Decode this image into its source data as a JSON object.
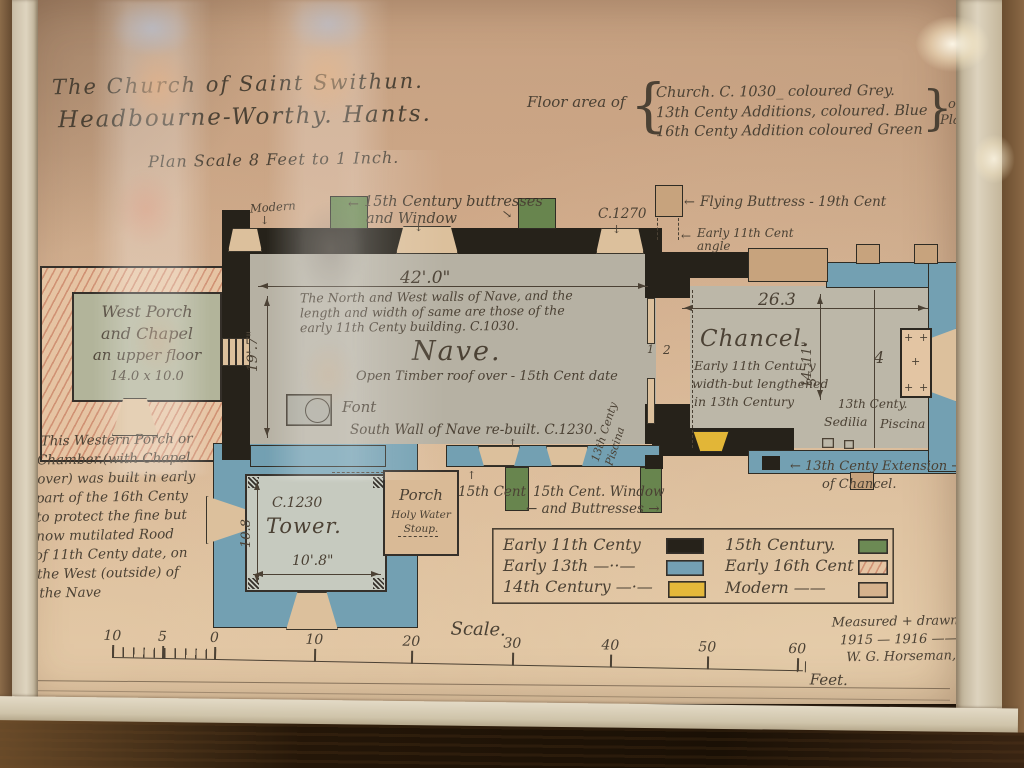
{
  "glyphs": {
    "left_arrow": "←",
    "right_arrow": "→",
    "up_arrow": "↑",
    "down_arrow": "↓",
    "brace_open": "{",
    "brace_close": "}",
    "paren_open": "(",
    "plus": "+"
  },
  "title": {
    "line1": "The Church of Saint Swithun.",
    "line2": "Headbourne-Worthy. Hants.",
    "scale_note": "Plan Scale 8 Feet to 1 Inch."
  },
  "floor_area": {
    "prefix": "Floor area of",
    "line1": "Church. C. 1030_ coloured Grey.",
    "line2": "13th Centy Additions, coloured. Blue",
    "line3": "16th Centy Addition coloured Green",
    "suffix1": "on",
    "suffix2": "Plan."
  },
  "nave": {
    "title": "Nave.",
    "subtitle": "Open Timber roof over - 15th Cent date",
    "width_dim": "42'.0\"",
    "height_dim": "19'.7\"",
    "note1": "The North and West walls of Nave, and the",
    "note2": "length and width of same are those of the",
    "note3": "early 11th Centy building. C.1030.",
    "font_label": "Font",
    "south_wall_note": "South Wall of Nave re-built. C.1230.",
    "piscina1": "13th Centy",
    "piscina2": "Piscina"
  },
  "chancel": {
    "title": "Chancel.",
    "note1": "Early 11th Century",
    "note2": "width-but lengthened",
    "note3": "in 13th Century",
    "width_dim": "26.3",
    "height_dim": "14'.11\"",
    "bay1": "1",
    "bay2": "2",
    "bay3": "3",
    "bay4": "4",
    "sedilia_heading": "13th Centy.",
    "sedilia": "Sedilia",
    "piscina": "Piscina",
    "extension1": "← 13th Centy Extension →",
    "extension2": "of Chancel."
  },
  "west_porch": {
    "line1": "West Porch",
    "line2": "and Chapel",
    "line3": "an upper floor",
    "dims": "14.0 x 10.0"
  },
  "west_porch_note": [
    "This Western Porch or",
    "Chamber.(with Chapel",
    "over) was built in early",
    "part of the 16th Centy",
    "to protect the fine but",
    "now mutilated Rood",
    "of 11th Centy date, on",
    "the West (outside) of",
    "the Nave"
  ],
  "tower": {
    "date": "C.1230",
    "title": "Tower.",
    "dim_v": "10.8",
    "dim_h": "10'.8\""
  },
  "porch": {
    "line1": "Porch",
    "line2": "Holy Water",
    "line3": "Stoup."
  },
  "annotations": {
    "modern": "Modern",
    "buttresses1": "15th Century buttresses",
    "buttresses2": "and Window",
    "c1270": "C.1270",
    "flying_buttress": "Flying Buttress - 19th Cent",
    "angle1": "Early 11th Cent",
    "angle2": "angle",
    "cent15": "15th Cent",
    "window1": "15th Cent. Window",
    "window2": "← and Buttresses →"
  },
  "legend": {
    "items": [
      {
        "label": "Early 11th Centy",
        "color": "#26221a",
        "pattern": "solid"
      },
      {
        "label": "Early 13th —··—",
        "color": "#74a0b4",
        "pattern": "solid"
      },
      {
        "label": "14th Century —·—",
        "color": "#e5b83a",
        "pattern": "solid"
      },
      {
        "label": "15th Century.",
        "color": "#6c8a54",
        "pattern": "solid"
      },
      {
        "label": "Early 16th Cent",
        "color": "#e7c6a6",
        "pattern": "hatched"
      },
      {
        "label": "Modern ——",
        "color": "#d6b28d",
        "pattern": "solid"
      }
    ]
  },
  "scale_bar": {
    "title": "Scale.",
    "ticks": [
      "10",
      "5",
      "0",
      "10",
      "20",
      "30",
      "40",
      "50",
      "60"
    ],
    "unit": "Feet."
  },
  "credit": {
    "line1": "Measured + drawn",
    "line2": "1915 — 1916 ——",
    "line3": "W. G. Horseman, Archt"
  },
  "colors": {
    "paper": "#cfab8c",
    "early_11th": "#26221a",
    "early_13th": "#74a0b4",
    "cent_14th": "#e5b83a",
    "cent_15th": "#6c8a54",
    "early_16th": "#e7c6a6",
    "modern_tan": "#d6b28d"
  }
}
